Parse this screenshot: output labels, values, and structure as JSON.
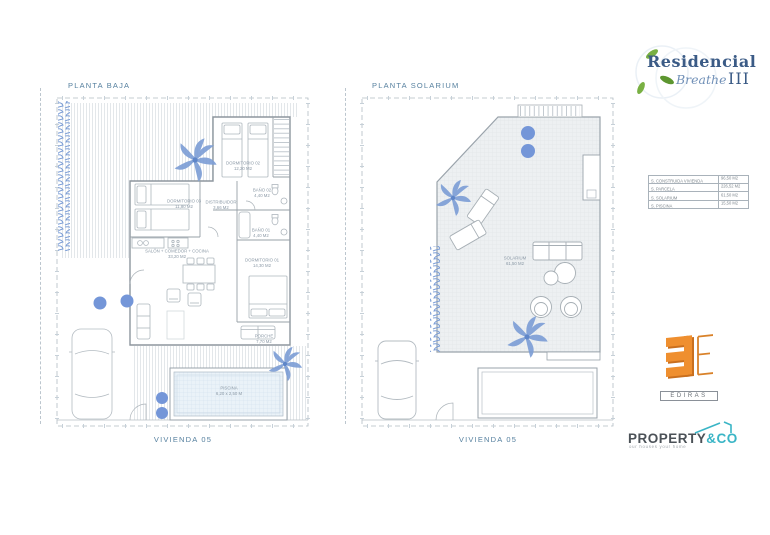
{
  "brand": {
    "residencial": "Residencial",
    "breathe": "Breathe",
    "numeral": "III"
  },
  "plans": [
    {
      "title": "PLANTA BAJA",
      "footer": "VIVIENDA 05",
      "labels": {
        "dorm02": {
          "name": "DORMITORIO 02",
          "area": "12,20 M2"
        },
        "dorm03": {
          "name": "DORMITORIO 03",
          "area": "11,80 M2"
        },
        "distribuidor": {
          "name": "DISTRIBUIDOR",
          "area": "3,66 M2"
        },
        "bano02": {
          "name": "BAÑO 02",
          "area": "4,40 M2"
        },
        "bano01": {
          "name": "BAÑO 01",
          "area": "4,40 M2"
        },
        "salon": {
          "name": "SALÓN + COMEDOR + COCINA",
          "area": "33,20 M2"
        },
        "dorm01": {
          "name": "DORMITORIO 01",
          "area": "14,30 M2"
        },
        "porche": {
          "name": "PORCHE",
          "area": "7,70 M2"
        },
        "piscina": {
          "name": "PISCINA",
          "area": "6,20 x 2,50 M"
        }
      }
    },
    {
      "title": "PLANTA SOLARIUM",
      "footer": "VIVIENDA 05",
      "labels": {
        "solarium": {
          "name": "SOLARIUM",
          "area": "61,50 M2"
        }
      }
    }
  ],
  "summary_table": {
    "title": "VIVIENDA 05",
    "rows": [
      {
        "label": "S. CONSTRUIDA VIVIENDA",
        "value": "96,50 M2"
      },
      {
        "label": "S. PARCELA",
        "value": "226,52 M2"
      },
      {
        "label": "S. SOLARIUM",
        "value": "61,50 M2"
      },
      {
        "label": "S. PISCINA",
        "value": "15,50 M2"
      }
    ]
  },
  "ediras": {
    "label": "EDIRAS"
  },
  "property": {
    "name": "PROPERTY",
    "suffix": "&CO",
    "tagline": "our houses your home"
  },
  "colors": {
    "plan_blue": "#7b9cd4",
    "title_blue": "#56809f",
    "wall_gray": "#8d969e",
    "ediras_orange": "#ef8f2f",
    "property_teal": "#3ab5c6",
    "leaf_green": "#79b043",
    "brand_blue": "#3b5b86"
  }
}
